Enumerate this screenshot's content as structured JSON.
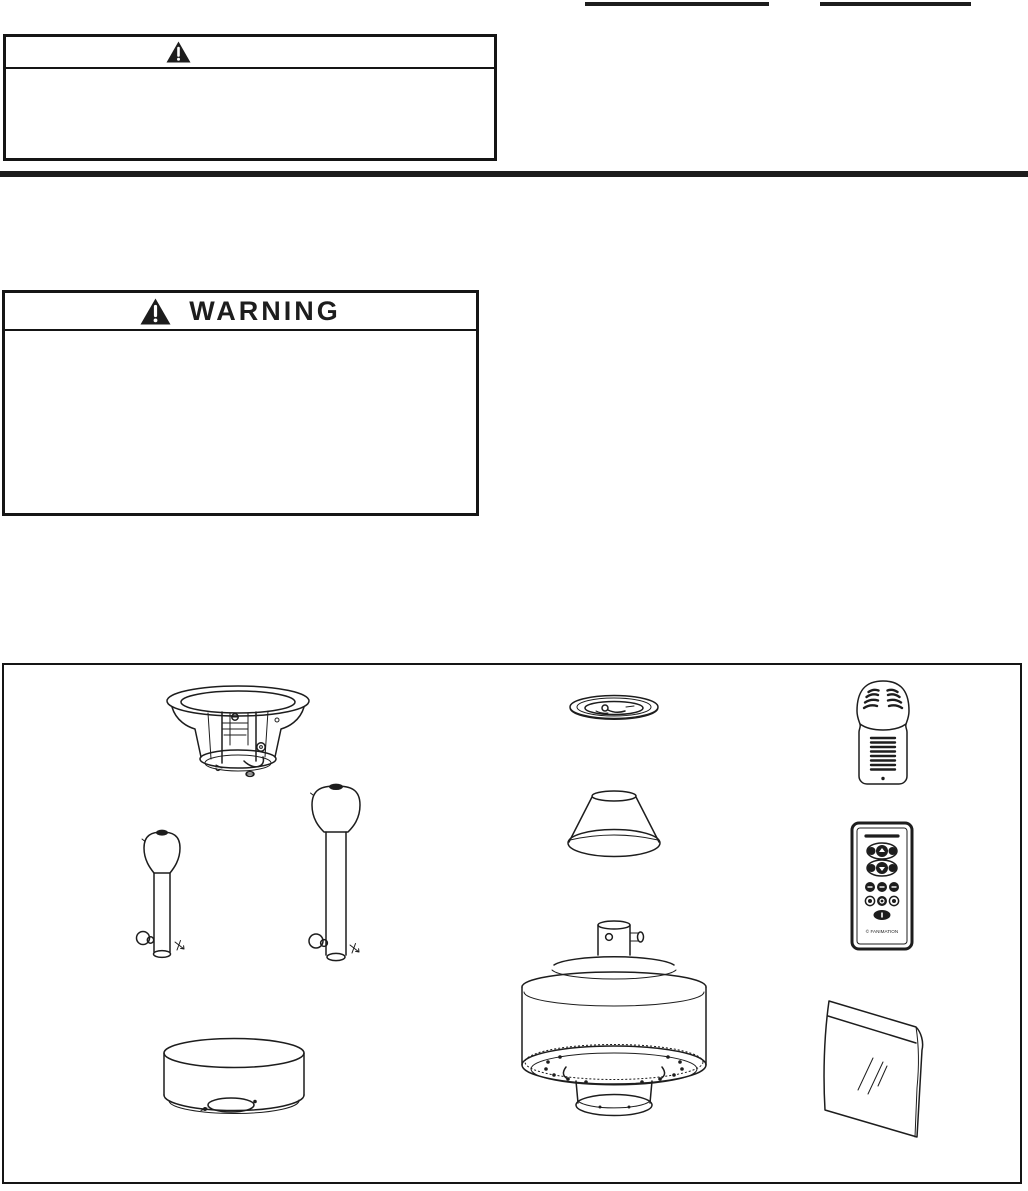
{
  "colors": {
    "ink": "#1d1d1d",
    "paper": "#ffffff"
  },
  "top_fields": [
    {
      "name": "write-in-line-left",
      "value": ""
    },
    {
      "name": "write-in-line-right",
      "value": ""
    }
  ],
  "caution_box": {
    "icon": "warning-triangle-icon",
    "title": "",
    "body_text": ""
  },
  "warning_box": {
    "icon": "warning-triangle-icon",
    "title": "WARNING",
    "body_text": ""
  },
  "parts_box": {
    "parts": [
      {
        "icon": "ceiling-mounting-bracket-icon"
      },
      {
        "icon": "ceiling-trim-ring-icon"
      },
      {
        "icon": "receiver-unit-icon"
      },
      {
        "icon": "downrod-short-icon"
      },
      {
        "icon": "downrod-long-icon"
      },
      {
        "icon": "canopy-icon"
      },
      {
        "icon": "handheld-remote-icon"
      },
      {
        "icon": "close-mount-housing-icon"
      },
      {
        "icon": "fan-motor-assembly-icon"
      },
      {
        "icon": "hardware-bag-icon"
      }
    ]
  },
  "remote": {
    "brand_text": "© FANIMATION"
  }
}
